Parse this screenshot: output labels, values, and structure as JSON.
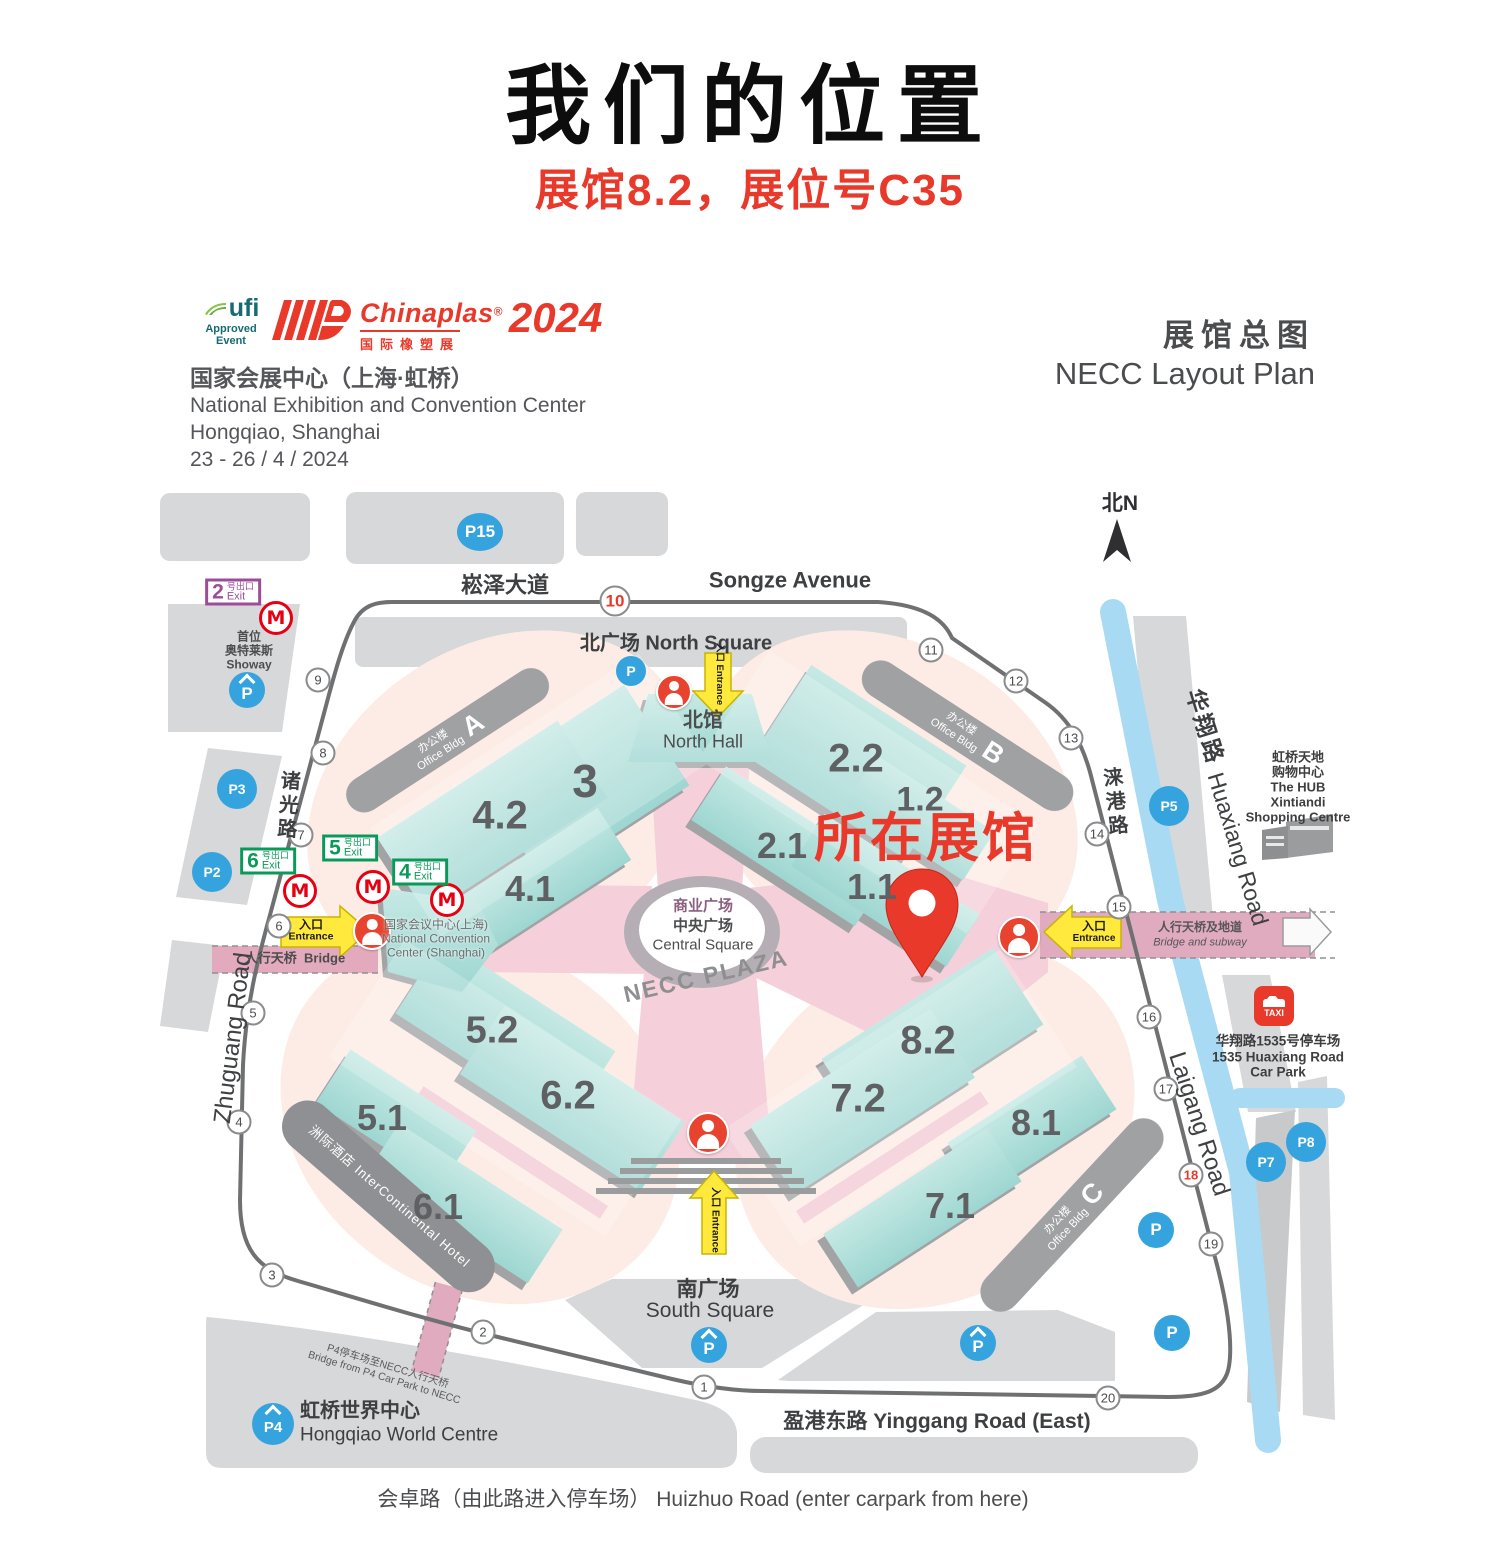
{
  "page": {
    "title": "我们的位置",
    "subtitle": "展馆8.2，展位号C35"
  },
  "header": {
    "ufi": {
      "name": "ufi",
      "approved": "Approved",
      "event": "Event"
    },
    "chinaplas": {
      "brand": "Chinaplas",
      "reg": "®",
      "cn": "国际橡塑展",
      "year": "2024"
    },
    "venue": {
      "cn": "国家会展中心（上海·虹桥）",
      "en1": "National Exhibition and Convention Center",
      "en2": "Hongqiao, Shanghai",
      "dates": "23 - 26 / 4 / 2024"
    },
    "plan_cn": "展馆总图",
    "plan_en": "NECC Layout Plan"
  },
  "map": {
    "compass": "北N",
    "marker_label": "所在展馆",
    "entrance": {
      "cn": "入口",
      "en": "Entrance"
    },
    "exit_text": {
      "cn": "号出口",
      "en": "Exit"
    },
    "roads": {
      "songze_cn": "崧泽大道",
      "songze_en": "Songze Avenue",
      "zhuguang_cn": "诸光路",
      "zhuguang_en": "Zhuguang Road",
      "laigang_cn": "涞港路",
      "laigang_en": "Laigang Road",
      "huaxiang_cn": "华翔路",
      "huaxiang_en": "Huaxiang Road",
      "yinggang": "盈港东路 Yinggang Road (East)",
      "huizhuo": "会卓路（由此路进入停车场）  Huizhuo Road (enter carpark from here)"
    },
    "areas": {
      "north_square": "北广场  North Square",
      "north_hall_cn": "北馆",
      "north_hall_en": "North Hall",
      "south_square_cn": "南广场",
      "south_square_en": "South Square",
      "central_cn1": "商业广场",
      "central_cn2": "中央广场",
      "central_en": "Central Square",
      "plaza": "NECC PLAZA"
    },
    "bands": {
      "west_cn": "人行天桥",
      "west_en": "Bridge",
      "east_cn": "人行天桥及地道",
      "east_en": "Bridge and subway"
    },
    "poi": {
      "showway": [
        "首位",
        "奥特莱斯",
        "Showay"
      ],
      "hub": [
        "虹桥天地",
        "购物中心",
        "The HUB",
        "Xintiandi",
        "Shopping Centre"
      ],
      "carpark1535": [
        "华翔路1535号停车场",
        "1535 Huaxiang Road",
        "Car Park"
      ],
      "hongqiao_cn": "虹桥世界中心",
      "hongqiao_en": "Hongqiao World Centre",
      "p4_bridge1": "P4停车场至NECC人行天桥",
      "p4_bridge2": "Bridge from P4 Car Park to NECC",
      "ncc1": "国家会议中心(上海)",
      "ncc2": "National Convention",
      "ncc3": "Center (Shanghai)",
      "intercontinental": "洲际酒店 InterContinental Hotel",
      "taxi": "TAXI"
    },
    "offices": [
      {
        "cn": "办公楼",
        "en": "Office Bldg",
        "letter": "A"
      },
      {
        "cn": "办公楼",
        "en": "Office Bldg",
        "letter": "B"
      },
      {
        "cn": "办公楼",
        "en": "Office Bldg",
        "letter": "C"
      }
    ],
    "halls": [
      {
        "label": "3",
        "x": 585,
        "y": 781,
        "fs": 46
      },
      {
        "label": "4.2",
        "x": 500,
        "y": 816,
        "fs": 40
      },
      {
        "label": "4.1",
        "x": 530,
        "y": 889,
        "fs": 36
      },
      {
        "label": "2.2",
        "x": 856,
        "y": 759,
        "fs": 40
      },
      {
        "label": "2.1",
        "x": 782,
        "y": 846,
        "fs": 36
      },
      {
        "label": "1.2",
        "x": 920,
        "y": 800,
        "fs": 34
      },
      {
        "label": "1.1",
        "x": 872,
        "y": 887,
        "fs": 36
      },
      {
        "label": "5.2",
        "x": 492,
        "y": 1031,
        "fs": 38
      },
      {
        "label": "6.2",
        "x": 568,
        "y": 1096,
        "fs": 40
      },
      {
        "label": "5.1",
        "x": 382,
        "y": 1118,
        "fs": 36
      },
      {
        "label": "6.1",
        "x": 438,
        "y": 1207,
        "fs": 36
      },
      {
        "label": "8.2",
        "x": 928,
        "y": 1041,
        "fs": 40
      },
      {
        "label": "7.2",
        "x": 858,
        "y": 1099,
        "fs": 40
      },
      {
        "label": "8.1",
        "x": 1036,
        "y": 1123,
        "fs": 36
      },
      {
        "label": "7.1",
        "x": 950,
        "y": 1206,
        "fs": 36
      }
    ],
    "ring": [
      {
        "n": "1",
        "x": 704,
        "y": 1387
      },
      {
        "n": "2",
        "x": 483,
        "y": 1332
      },
      {
        "n": "3",
        "x": 272,
        "y": 1275
      },
      {
        "n": "4",
        "x": 239,
        "y": 1122
      },
      {
        "n": "5",
        "x": 253,
        "y": 1013
      },
      {
        "n": "6",
        "x": 279,
        "y": 926
      },
      {
        "n": "7",
        "x": 301,
        "y": 835
      },
      {
        "n": "8",
        "x": 323,
        "y": 753
      },
      {
        "n": "9",
        "x": 318,
        "y": 680
      },
      {
        "n": "10",
        "x": 615,
        "y": 601,
        "red": true,
        "big": true
      },
      {
        "n": "11",
        "x": 931,
        "y": 650
      },
      {
        "n": "12",
        "x": 1016,
        "y": 681
      },
      {
        "n": "13",
        "x": 1071,
        "y": 738
      },
      {
        "n": "14",
        "x": 1097,
        "y": 834
      },
      {
        "n": "15",
        "x": 1119,
        "y": 907
      },
      {
        "n": "16",
        "x": 1149,
        "y": 1017
      },
      {
        "n": "17",
        "x": 1166,
        "y": 1089
      },
      {
        "n": "18",
        "x": 1191,
        "y": 1175,
        "red": true
      },
      {
        "n": "19",
        "x": 1211,
        "y": 1244
      },
      {
        "n": "20",
        "x": 1108,
        "y": 1398
      }
    ],
    "parking": [
      {
        "label": "P15",
        "x": 480,
        "y": 532,
        "w": 46,
        "h": 38
      },
      {
        "label": "P3",
        "x": 237,
        "y": 789,
        "w": 40,
        "h": 40
      },
      {
        "label": "P2",
        "x": 212,
        "y": 872,
        "w": 40,
        "h": 40
      },
      {
        "label": "P5",
        "x": 1169,
        "y": 806,
        "w": 40,
        "h": 40
      },
      {
        "label": "P7",
        "x": 1266,
        "y": 1162,
        "w": 40,
        "h": 40
      },
      {
        "label": "P8",
        "x": 1306,
        "y": 1142,
        "w": 40,
        "h": 40
      },
      {
        "label": "P",
        "x": 631,
        "y": 671,
        "w": 30,
        "h": 30
      },
      {
        "label": "P",
        "x": 1156,
        "y": 1230,
        "w": 36,
        "h": 36
      },
      {
        "label": "P",
        "x": 1172,
        "y": 1333,
        "w": 36,
        "h": 36
      },
      {
        "label": "P",
        "x": 247,
        "y": 690,
        "w": 36,
        "h": 36,
        "roof": true
      },
      {
        "label": "P",
        "x": 709,
        "y": 1345,
        "w": 36,
        "h": 36,
        "roof": true
      },
      {
        "label": "P",
        "x": 978,
        "y": 1343,
        "w": 36,
        "h": 36,
        "roof": true
      },
      {
        "label": "P4",
        "x": 273,
        "y": 1424,
        "w": 42,
        "h": 42,
        "roof": true
      }
    ],
    "metro": [
      {
        "x": 276,
        "y": 618
      },
      {
        "x": 300,
        "y": 891
      },
      {
        "x": 373,
        "y": 887
      },
      {
        "x": 447,
        "y": 900
      }
    ],
    "exits": [
      {
        "num": "2",
        "x": 233,
        "y": 592,
        "color": "#9c4d9a"
      },
      {
        "num": "6",
        "x": 268,
        "y": 861,
        "color": "#0a9a58"
      },
      {
        "num": "5",
        "x": 350,
        "y": 848,
        "color": "#0a9a58"
      },
      {
        "num": "4",
        "x": 420,
        "y": 872,
        "color": "#0a9a58"
      }
    ],
    "persons": [
      {
        "x": 372,
        "y": 931,
        "r": 17
      },
      {
        "x": 674,
        "y": 692,
        "r": 16
      },
      {
        "x": 708,
        "y": 1133,
        "r": 19
      },
      {
        "x": 1019,
        "y": 937,
        "r": 19
      }
    ]
  }
}
